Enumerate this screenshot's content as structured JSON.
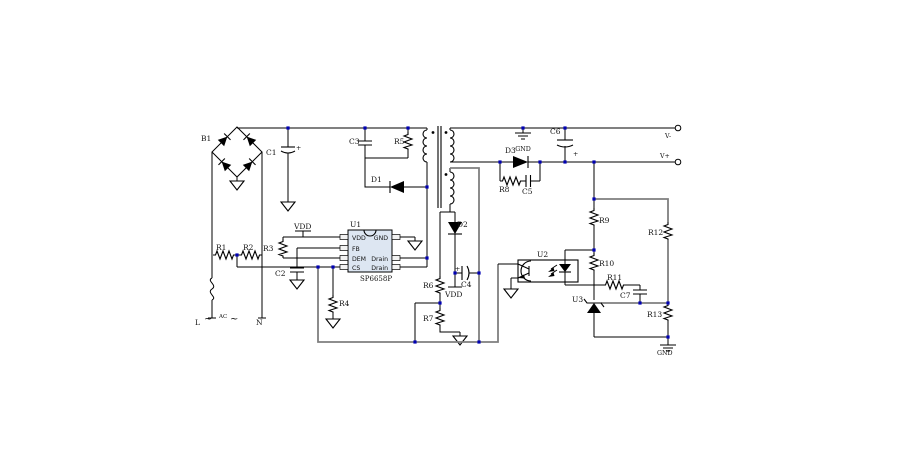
{
  "schematic": {
    "background": "#ffffff",
    "colors": {
      "wire": "#000000",
      "bus_wire": "#7f7f7f",
      "junction": "#0000b4",
      "ic_fill": "#dde6f2",
      "text": "#111111"
    },
    "labels": {
      "b1": "B1",
      "c1": "C1",
      "c2": "C2",
      "c3": "C3",
      "c4": "C4",
      "c5": "C5",
      "c6": "C6",
      "c7": "C7",
      "r1": "R1",
      "r2": "R2",
      "r3": "R3",
      "r4": "R4",
      "r5": "R5",
      "r6": "R6",
      "r7": "R7",
      "r8": "R8",
      "r9": "R9",
      "r10": "R10",
      "r11": "R11",
      "r12": "R12",
      "r13": "R13",
      "d1": "D1",
      "d2": "D2",
      "d3": "D3",
      "u2": "U2",
      "u3": "U3",
      "plus": "+"
    },
    "ic_u1": {
      "refdes": "U1",
      "part": "SP6658P",
      "pins_left": [
        "VDD",
        "FB",
        "DEM",
        "CS"
      ],
      "pins_right": [
        "GND",
        "Drain",
        "Drain"
      ]
    },
    "power": {
      "vdd_primary": "VDD",
      "vdd_aux": "VDD",
      "gnd_secondary": "GND",
      "gnd_output": "GND"
    },
    "ac_input": {
      "line": "L",
      "label": "AC",
      "neutral": "N",
      "tilde": "~"
    },
    "outputs": {
      "v_minus": "V-",
      "v_plus": "V+"
    }
  }
}
